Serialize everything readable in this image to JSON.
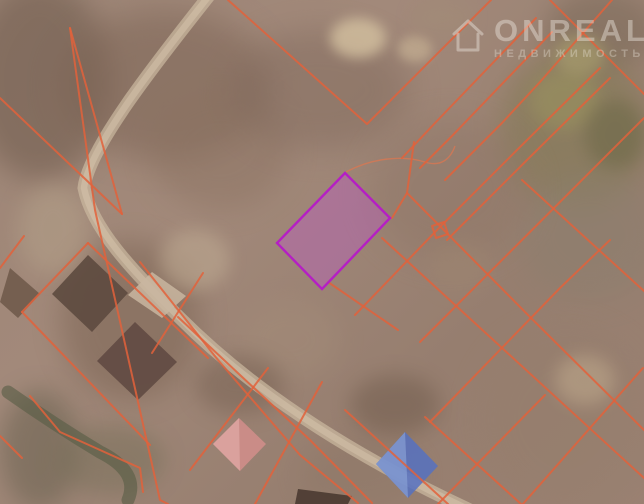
{
  "window": {
    "width": 644,
    "height": 504,
    "view": "satellite-cadastral-map"
  },
  "watermark": {
    "brand": "ONREALT",
    "subtitle": "НЕДВИЖИМОСТЬ",
    "icon": "house-logo-icon",
    "color": "#f4efe8"
  },
  "map": {
    "colors": {
      "parcel_line": "#e2613b",
      "parcel_line_opacity": 0.85,
      "highlight_stroke": "#b51fc4",
      "highlight_fill": "rgba(197,85,210,0.34)",
      "road": "#cbb8a0",
      "road_inner": "#dccab2",
      "stream": "#565b45",
      "track": "#e0764f"
    },
    "terrain": {
      "base": "#9c8374",
      "blobs": [
        {
          "x": -30,
          "y": -20,
          "w": 140,
          "h": 200,
          "c": "#6e5a4c",
          "o": 0.55,
          "b": 14
        },
        {
          "x": 60,
          "y": 10,
          "w": 210,
          "h": 150,
          "c": "#7a6253",
          "o": 0.5,
          "b": 16
        },
        {
          "x": 150,
          "y": 90,
          "w": 140,
          "h": 120,
          "c": "#8a7160",
          "o": 0.45,
          "b": 14
        },
        {
          "x": 230,
          "y": 30,
          "w": 180,
          "h": 120,
          "c": "#7e675a",
          "o": 0.45,
          "b": 16
        },
        {
          "x": 330,
          "y": 18,
          "w": 56,
          "h": 40,
          "c": "#d8c5a3",
          "o": 0.75,
          "b": 6
        },
        {
          "x": 398,
          "y": 36,
          "w": 34,
          "h": 26,
          "c": "#cbb697",
          "o": 0.6,
          "b": 5
        },
        {
          "x": 412,
          "y": 0,
          "w": 60,
          "h": 36,
          "c": "#a28c77",
          "o": 0.5,
          "b": 8
        },
        {
          "x": 545,
          "y": -10,
          "w": 110,
          "h": 80,
          "c": "#7b6a59",
          "o": 0.55,
          "b": 12
        },
        {
          "x": 500,
          "y": 48,
          "w": 150,
          "h": 160,
          "c": "#837a55",
          "o": 0.6,
          "b": 14
        },
        {
          "x": 530,
          "y": 70,
          "w": 70,
          "h": 60,
          "c": "#9a925f",
          "o": 0.6,
          "b": 8
        },
        {
          "x": 585,
          "y": 100,
          "w": 60,
          "h": 70,
          "c": "#6c6847",
          "o": 0.55,
          "b": 8
        },
        {
          "x": 555,
          "y": 35,
          "w": 50,
          "h": 40,
          "c": "#b0a671",
          "o": 0.55,
          "b": 7
        },
        {
          "x": 520,
          "y": 170,
          "w": 140,
          "h": 130,
          "c": "#8b7f6e",
          "o": 0.5,
          "b": 14
        },
        {
          "x": 370,
          "y": 120,
          "w": 160,
          "h": 140,
          "c": "#8a7263",
          "o": 0.35,
          "b": 16
        },
        {
          "x": 60,
          "y": 240,
          "w": 140,
          "h": 160,
          "c": "#6f5847",
          "o": 0.4,
          "b": 14
        },
        {
          "x": 0,
          "y": 390,
          "w": 80,
          "h": 120,
          "c": "#665f4d",
          "o": 0.5,
          "b": 12
        },
        {
          "x": 55,
          "y": 425,
          "w": 110,
          "h": 70,
          "c": "#78705a",
          "o": 0.5,
          "b": 10
        },
        {
          "x": 160,
          "y": 230,
          "w": 70,
          "h": 60,
          "c": "#c2ae95",
          "o": 0.5,
          "b": 8
        },
        {
          "x": 18,
          "y": 185,
          "w": 70,
          "h": 90,
          "c": "#b5a28a",
          "o": 0.5,
          "b": 10
        },
        {
          "x": 240,
          "y": 300,
          "w": 100,
          "h": 80,
          "c": "#a58e7a",
          "o": 0.4,
          "b": 12
        },
        {
          "x": 480,
          "y": 330,
          "w": 170,
          "h": 180,
          "c": "#957e6c",
          "o": 0.4,
          "b": 16
        },
        {
          "x": 555,
          "y": 355,
          "w": 60,
          "h": 50,
          "c": "#c3ad8f",
          "o": 0.5,
          "b": 8
        },
        {
          "x": 300,
          "y": 440,
          "w": 120,
          "h": 70,
          "c": "#8d7766",
          "o": 0.4,
          "b": 12
        },
        {
          "x": 195,
          "y": 355,
          "w": 90,
          "h": 60,
          "c": "#6d5849",
          "o": 0.4,
          "b": 10
        },
        {
          "x": 350,
          "y": 375,
          "w": 90,
          "h": 60,
          "c": "#6b5748",
          "o": 0.45,
          "b": 10
        },
        {
          "x": 430,
          "y": 240,
          "w": 60,
          "h": 50,
          "c": "#a08871",
          "o": 0.4,
          "b": 10
        }
      ]
    },
    "roads": [
      {
        "name": "main-road",
        "path": "M212,-8 C150,70 88,150 84,188 C92,228 130,268 180,318 C240,378 330,445 470,510",
        "width": 13
      }
    ],
    "stream": {
      "path": "M8,392 Q55,425 100,452 Q140,472 128,500",
      "width": 13
    },
    "track": {
      "path": "M346,172 C372,158 402,155 425,162 C440,167 450,160 455,146",
      "width": 1.4
    },
    "parcel_lines": [
      {
        "points": "70,28 95,210 160,500 168,504"
      },
      {
        "points": "70,28 122,214"
      },
      {
        "points": "0,98 122,214"
      },
      {
        "points": "24,236 0,268"
      },
      {
        "points": "88,243 22,312"
      },
      {
        "points": "22,312 150,445"
      },
      {
        "points": "88,243 208,358"
      },
      {
        "points": "203,273 152,353"
      },
      {
        "points": "268,368 190,470"
      },
      {
        "points": "322,382 255,504"
      },
      {
        "points": "140,262 218,360 300,455 358,503"
      },
      {
        "points": "178,317 240,375 310,440 372,503"
      },
      {
        "points": "228,0 367,124 491,0"
      },
      {
        "points": "402,158 436,122 536,18"
      },
      {
        "points": "420,168 452,136 552,32"
      },
      {
        "points": "550,0 644,94"
      },
      {
        "points": "612,0 540,82 502,123 445,180"
      },
      {
        "points": "522,180 644,291"
      },
      {
        "points": "407,193 530,317 644,430"
      },
      {
        "points": "382,238 644,478"
      },
      {
        "points": "600,68 517,150 437,230 355,315"
      },
      {
        "points": "447,240 527,160 610,78"
      },
      {
        "points": "644,118 530,232 420,342"
      },
      {
        "points": "643,368 522,505"
      },
      {
        "points": "610,240 560,288 430,422"
      },
      {
        "points": "545,395 438,504"
      },
      {
        "points": "345,410 448,504"
      },
      {
        "points": "425,417 521,504"
      },
      {
        "points": "392,218 407,193 414,142"
      },
      {
        "points": "328,282 398,330"
      },
      {
        "points": "432,226 444,222 448,234 436,238 432,226"
      },
      {
        "points": "30,396 60,432 100,450 140,468 143,492"
      },
      {
        "points": "0,436 22,458"
      }
    ],
    "highlight_parcel": {
      "points": "345,173 390,218 322,289 277,243"
    },
    "houses": [
      {
        "name": "dark-roof-house",
        "points": "88,255 128,293 92,332 52,294",
        "color": "#5d4a3f",
        "opacity": 0.9
      },
      {
        "name": "dark-roof-house",
        "points": "135,322 177,362 138,400 97,361",
        "color": "#614a42",
        "opacity": 0.9
      },
      {
        "name": "light-roof-house",
        "points": "152,272 186,296 162,318 128,295",
        "color": "#c9b6a0",
        "opacity": 0.85
      },
      {
        "name": "dark-roof-house",
        "points": "10,268 40,294 18,318 0,302",
        "color": "#6a5546",
        "opacity": 0.8
      },
      {
        "name": "pink-roof-house",
        "points": "239,418 266,444 240,471 213,444",
        "color": "#cf8d8a",
        "opacity": 0.9
      },
      {
        "name": "pink-roof-house-shade",
        "points": "239,418 240,471 213,444",
        "color": "#dfa8a4",
        "opacity": 0.75
      },
      {
        "name": "blue-roof-house",
        "points": "405,432 438,466 408,498 376,464",
        "color": "#5671c1",
        "opacity": 0.85
      },
      {
        "name": "blue-roof-house-shade",
        "points": "405,432 376,464 408,498",
        "color": "#8ea6d8",
        "opacity": 0.6
      },
      {
        "name": "dark-roof-house",
        "points": "298,489 352,496 348,504 295,504",
        "color": "#4a3a31",
        "opacity": 0.9
      }
    ]
  }
}
